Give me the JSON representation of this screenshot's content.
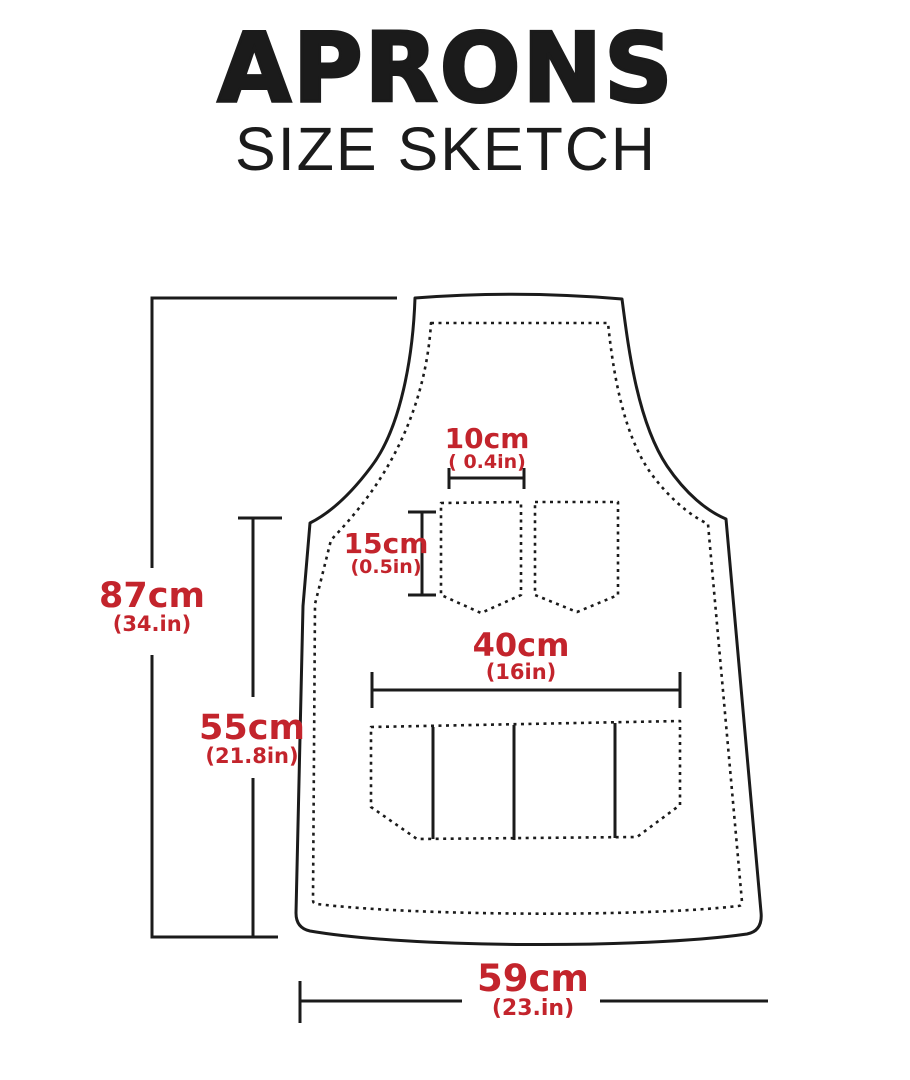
{
  "header": {
    "title": "APRONS",
    "subtitle": "SIZE SKETCH"
  },
  "colors": {
    "accent_red": "#c3242c",
    "line_black": "#1b1b1b"
  },
  "diagram": {
    "type": "apron-size-sketch",
    "measurements": {
      "total_height": {
        "value": "87cm",
        "inches": "(34.in)"
      },
      "skirt_height": {
        "value": "55cm",
        "inches": "(21.8in)"
      },
      "chest_pocket_width": {
        "value": "10cm",
        "inches": "( 0.4in)"
      },
      "chest_pocket_height": {
        "value": "15cm",
        "inches": "(0.5in)"
      },
      "front_pocket_width": {
        "value": "40cm",
        "inches": "(16in)"
      },
      "bottom_width": {
        "value": "59cm",
        "inches": "(23.in)"
      }
    }
  }
}
